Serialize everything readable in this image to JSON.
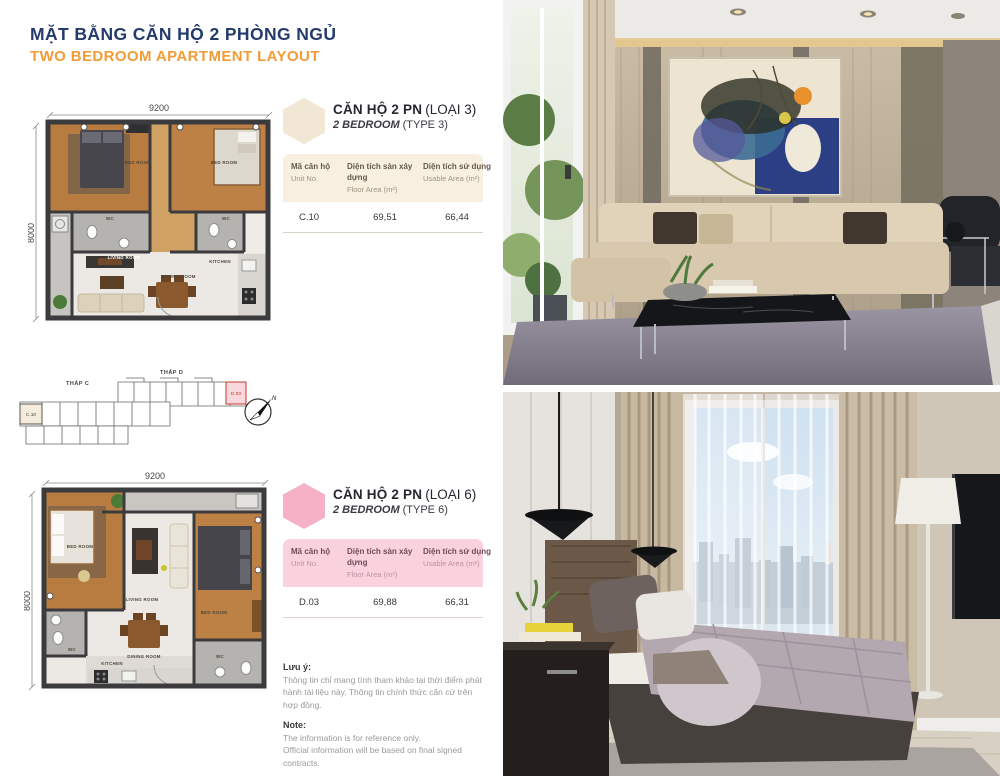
{
  "header": {
    "title_vi": "MẶT BẰNG CĂN HỘ 2 PHÒNG NGỦ",
    "title_en": "TWO BEDROOM APARTMENT LAYOUT"
  },
  "site_plan": {
    "tower_c_label": "THÁP C",
    "tower_d_label": "THÁP D",
    "unit_c": "C.10",
    "unit_d": "D.03",
    "compass_n": "N"
  },
  "plans": [
    {
      "dim_width": "9200",
      "dim_height": "8000",
      "rooms": {
        "bed1": "BED ROOM",
        "bed2": "BED ROOM",
        "wc1": "WC",
        "wc2": "WC",
        "living": "LIVING ROOM",
        "dining": "DINING ROOM",
        "kitchen": "KITCHEN"
      },
      "card": {
        "title_vi_bold": "CĂN HỘ 2 PN",
        "title_vi_note": "(LOẠI 3)",
        "title_en_bold": "2 BEDROOM",
        "title_en_note": "(TYPE 3)",
        "accent_color": "#f2e7d4",
        "header_color": "#f8efe1",
        "table": {
          "col1_vi": "Mã căn hộ",
          "col1_en": "Unit No.",
          "col2_vi": "Diện tích sàn xây dựng",
          "col2_en": "Floor Area (m²)",
          "col3_vi": "Diện tích sử dụng",
          "col3_en": "Usable Area (m²)",
          "row": {
            "unit": "C.10",
            "floor_area": "69,51",
            "usable_area": "66,44"
          }
        }
      }
    },
    {
      "dim_width": "9200",
      "dim_height": "8000",
      "rooms": {
        "bed1": "BED ROOM",
        "bed2": "BED ROOM",
        "wc1": "WC",
        "wc2": "WC",
        "living": "LIVING ROOM",
        "dining": "DINING ROOM",
        "kitchen": "KITCHEN"
      },
      "card": {
        "title_vi_bold": "CĂN HỘ 2 PN",
        "title_vi_note": "(LOẠI 6)",
        "title_en_bold": "2 BEDROOM",
        "title_en_note": "(TYPE 6)",
        "accent_color": "#f6b1c6",
        "header_color": "#fad2de",
        "table": {
          "col1_vi": "Mã căn hộ",
          "col1_en": "Unit No.",
          "col2_vi": "Diện tích sàn xây dựng",
          "col2_en": "Floor Area (m²)",
          "col3_vi": "Diện tích sử dụng",
          "col3_en": "Usable Area (m²)",
          "row": {
            "unit": "D.03",
            "floor_area": "69,88",
            "usable_area": "66,31"
          }
        }
      }
    }
  ],
  "notes": {
    "vi_label": "Lưu ý:",
    "vi_text": "Thông tin chỉ mang tính tham khảo tại thời điểm phát hành tài liệu này. Thông tin chính thức căn cứ trên hợp đồng.",
    "en_label": "Note:",
    "en_line1": "The information is for reference only.",
    "en_line2": "Official information will be based on final signed contracts."
  }
}
